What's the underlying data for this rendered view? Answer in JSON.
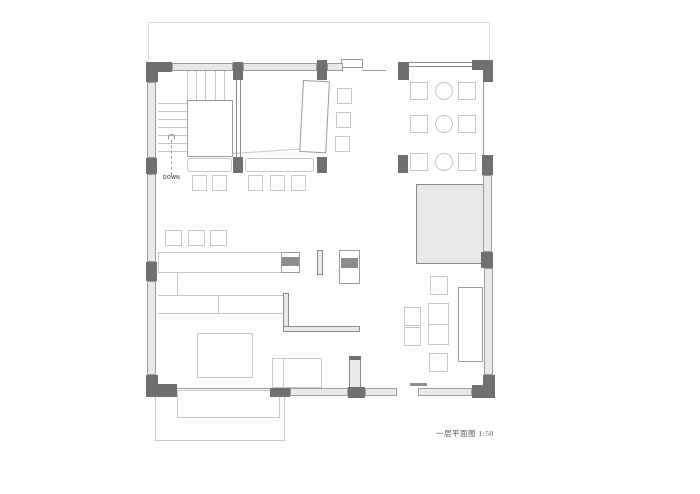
{
  "drawing": {
    "title": "一层平面图 1:50",
    "stair_label": "DOWN"
  },
  "colors": {
    "background": "#ffffff",
    "wall_dark": "#707070",
    "window_fill": "#e9e9e9",
    "window_border": "#9c9c9c",
    "structure_line": "#8a8a8a",
    "furniture_line": "#c6c6c6",
    "appliance_band": "#8d8d8d",
    "outline_faint": "#dedede",
    "text": "#5a5a5a"
  }
}
